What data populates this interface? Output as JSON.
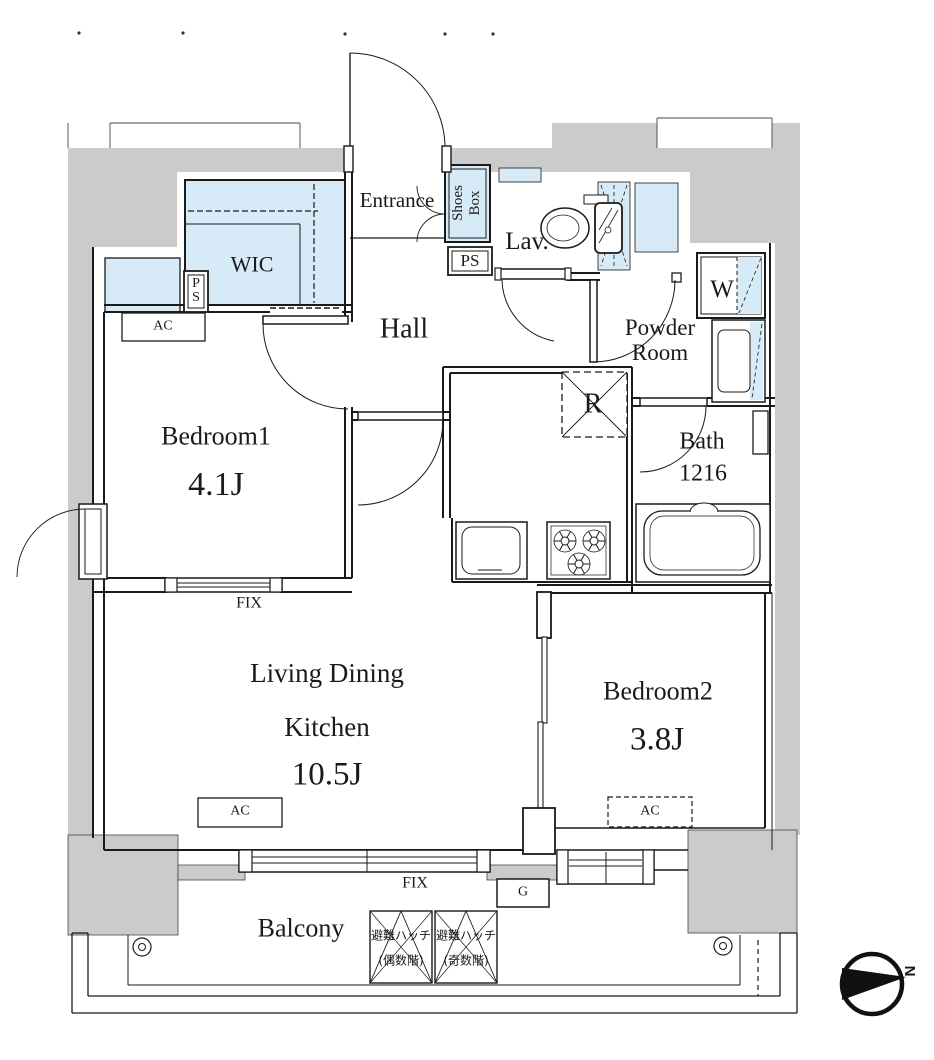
{
  "colors": {
    "wall_fill": "#cbcbcb",
    "fixture_fill": "#d6eaf8",
    "line": "#1a1a1a"
  },
  "rooms": {
    "entrance": {
      "label": "Entrance",
      "shoes_box": "Shoes Box",
      "ps": "PS"
    },
    "lav": {
      "label": "Lav."
    },
    "wic": {
      "label": "WIC",
      "ps": "PS"
    },
    "hall": {
      "label": "Hall"
    },
    "powder_room": {
      "label": "Powder Room",
      "washer": "W"
    },
    "kitchen": {
      "refrigerator": "R"
    },
    "bath": {
      "label": "Bath",
      "size": "1216"
    },
    "bedroom1": {
      "label": "Bedroom1",
      "size": "4.1J",
      "ac": "AC"
    },
    "ldk": {
      "line1": "Living Dining",
      "line2": "Kitchen",
      "size": "10.5J",
      "ac": "AC"
    },
    "bedroom2": {
      "label": "Bedroom2",
      "size": "3.8J",
      "ac": "AC"
    },
    "windows": {
      "fix1": "FIX",
      "fix2": "FIX"
    },
    "balcony": {
      "label": "Balcony",
      "gas": "G",
      "hatch_even": {
        "line1": "避難ハッチ",
        "line2": "(偶数階)"
      },
      "hatch_odd": {
        "line1": "避難ハッチ",
        "line2": "(奇数階)"
      }
    },
    "compass": {
      "north": "N"
    }
  }
}
